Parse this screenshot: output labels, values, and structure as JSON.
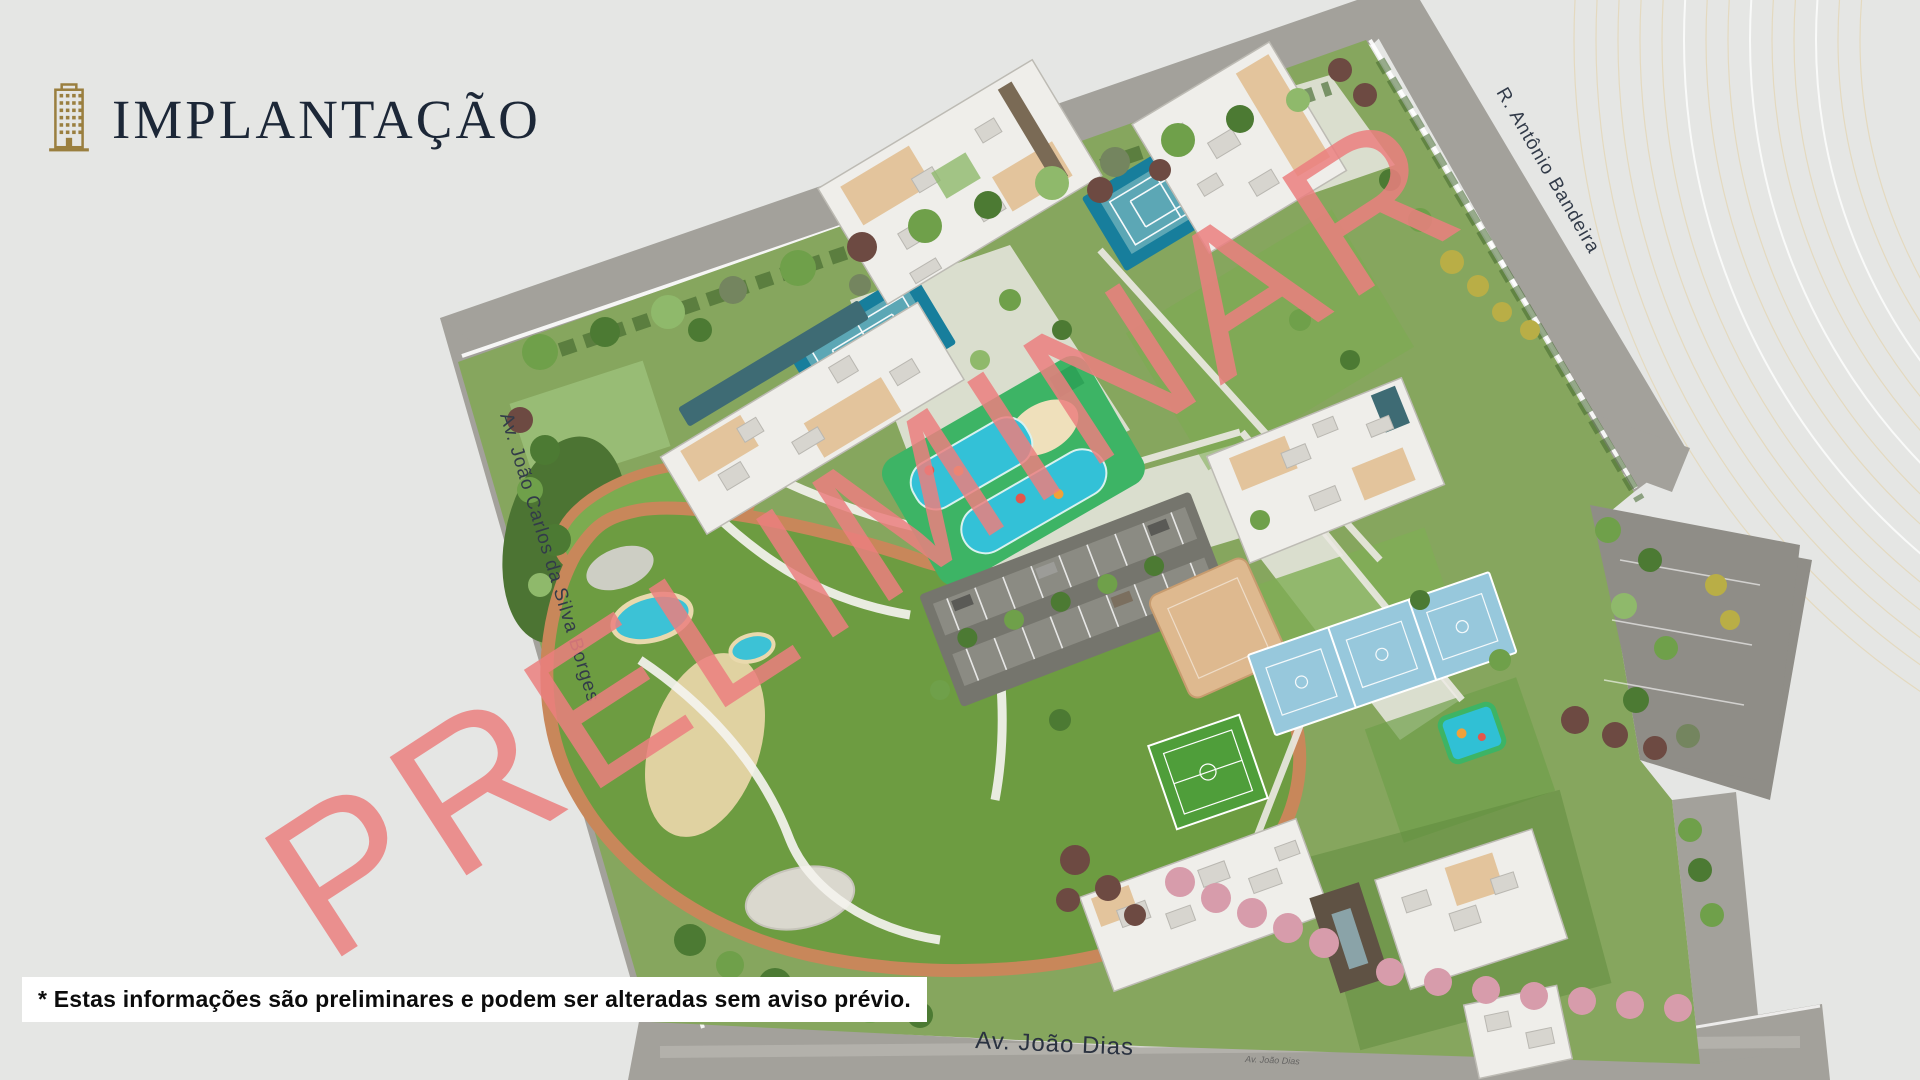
{
  "header": {
    "title": "IMPLANTAÇÃO"
  },
  "watermark": {
    "text": "PRELIMINAR",
    "color": "#eb7f7f"
  },
  "disclaimer": {
    "text": "* Estas informações são preliminares e podem ser alteradas sem aviso prévio."
  },
  "map": {
    "streets": [
      {
        "name": "Av. João Carlos da Silva Borges"
      },
      {
        "name": "R. Antônio Bandeira"
      },
      {
        "name": "Av. João Dias"
      },
      {
        "name": "Av. João Dias"
      }
    ],
    "palette": {
      "background": "#e5e6e4",
      "road": "#a3a19b",
      "campus_green": "#86a65e",
      "lawn": "#6d9c41",
      "walking_track": "#c8875a",
      "water": "#33c1d7",
      "tennis_court": "#177e9c",
      "sport_court": "#97c8dc",
      "building": "#efeeea",
      "roof_beige": "#e3c49c",
      "flowering_tree": "#d79cab",
      "watermark": "#eb7f7f",
      "brand_gold": "#9a7f3f",
      "title_ink": "#1c2737",
      "decor_line": "#e4d7b6"
    }
  }
}
